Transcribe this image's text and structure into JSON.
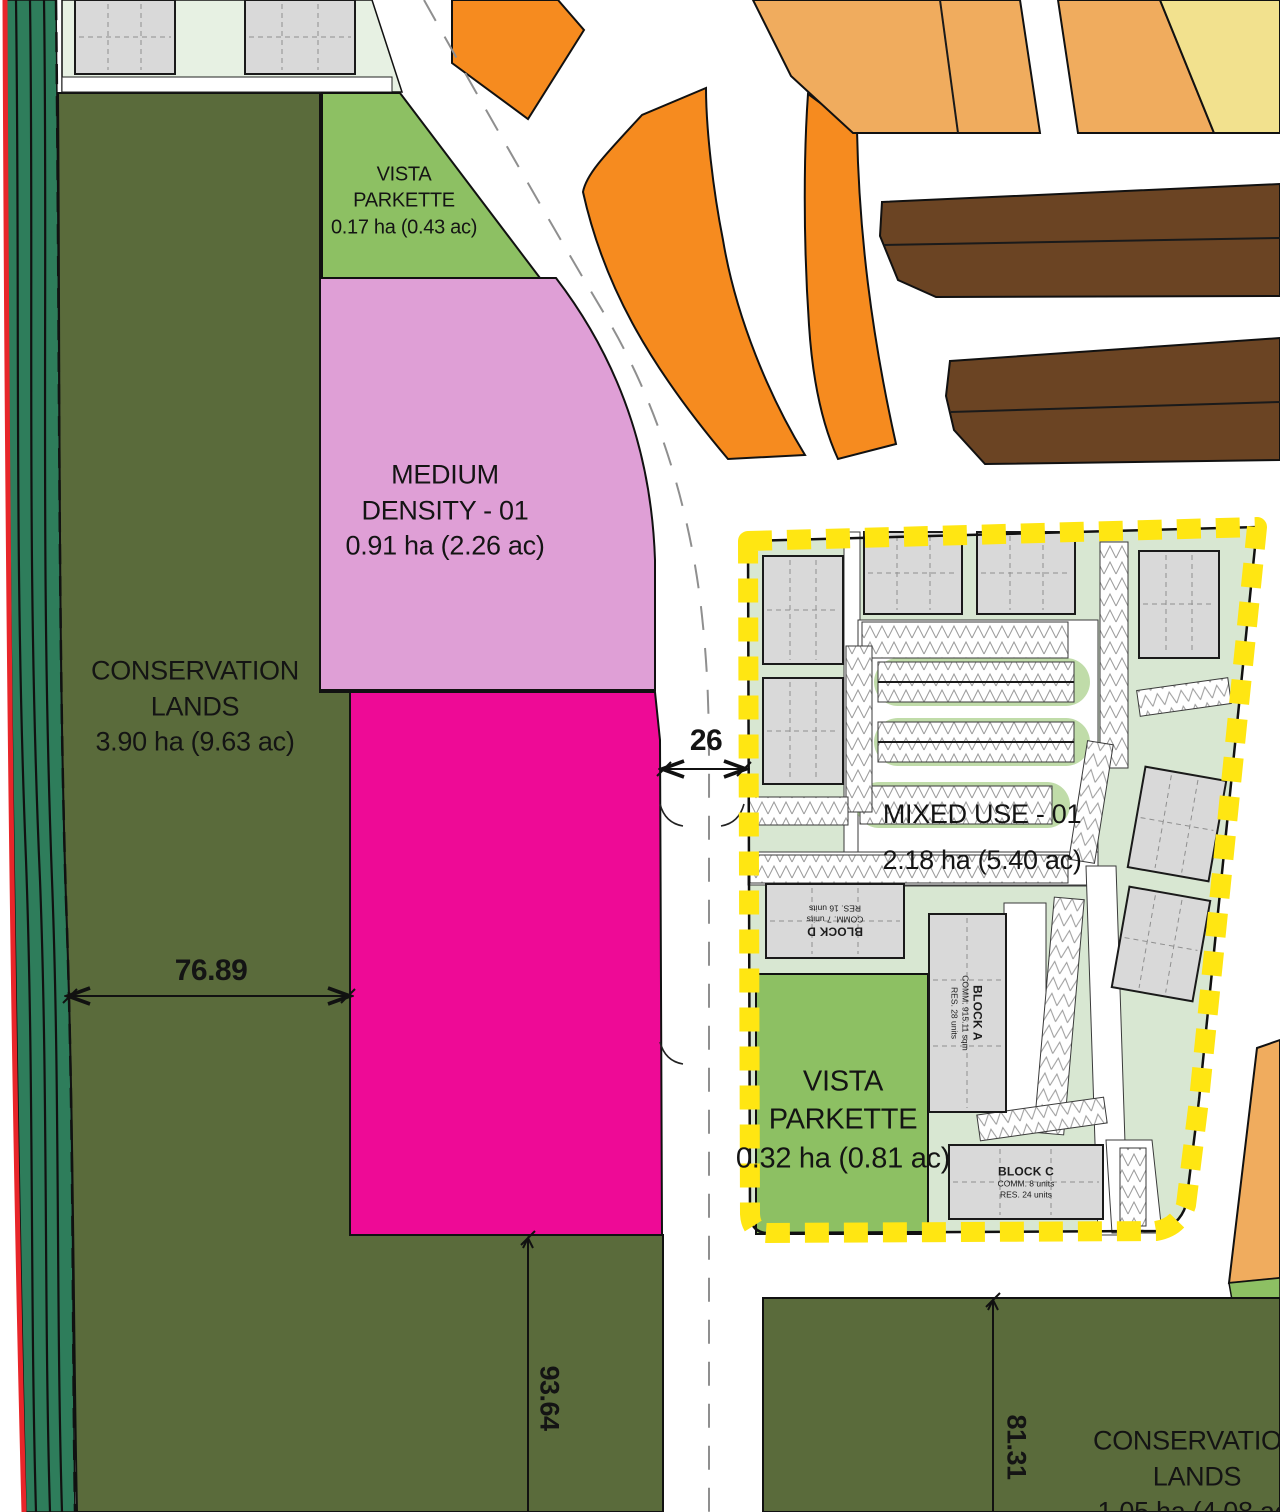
{
  "areas": {
    "conservation_west": {
      "line1": "CONSERVATION",
      "line2": "LANDS",
      "line3": "3.90 ha (9.63 ac)"
    },
    "vista_parkette_north": {
      "line1": "VISTA",
      "line2": "PARKETTE",
      "line3": "0.17 ha (0.43 ac)"
    },
    "medium_density_01": {
      "line1": "MEDIUM",
      "line2": "DENSITY - 01",
      "line3": "0.91 ha (2.26 ac)"
    },
    "mixed_use_01": {
      "line1": "MIXED USE - 01",
      "line2": "2.18 ha (5.40 ac)"
    },
    "vista_parkette_south": {
      "line1": "VISTA",
      "line2": "PARKETTE",
      "line3": "0.32 ha (0.81 ac)"
    },
    "conservation_southeast": {
      "line1": "CONSERVATION",
      "line2": "LANDS",
      "line3": "1.05 ha (4.08 ac)"
    }
  },
  "blocks": {
    "block_a": {
      "name": "BLOCK A",
      "comm": "COMM. 915.11 sqm",
      "res": "RES. 28 units"
    },
    "block_c": {
      "name": "BLOCK C",
      "comm": "COMM. 8 units",
      "res": "RES. 24 units"
    },
    "block_d": {
      "name": "BLOCK D",
      "comm": "COMM. 7 units",
      "res": "RES. 16 units"
    }
  },
  "dimensions": {
    "road_width": "26",
    "conservation_west_width": "76.89",
    "parcel_south_depth": "93.64",
    "conservation_southeast_depth": "81.31"
  },
  "colors": {
    "conservation_green": "#5a6b3b",
    "buffer_green": "#2e7d5b",
    "edge_red": "#e8262a",
    "parkette_green": "#8dc063",
    "residential_lot_green": "#e7f1e3",
    "mixed_use_green": "#d8e7d2",
    "medium_density_pink": "#df9fd6",
    "high_density_magenta": "#ee0a96",
    "townhouse_orange": "#f68b1f",
    "townhouse_tan": "#f0ac5e",
    "townhouse_yellow": "#f2e18e",
    "townhouse_brown": "#6b4423",
    "boundary_yellow": "#ffe612",
    "building_grey": "#d9d9d9"
  }
}
